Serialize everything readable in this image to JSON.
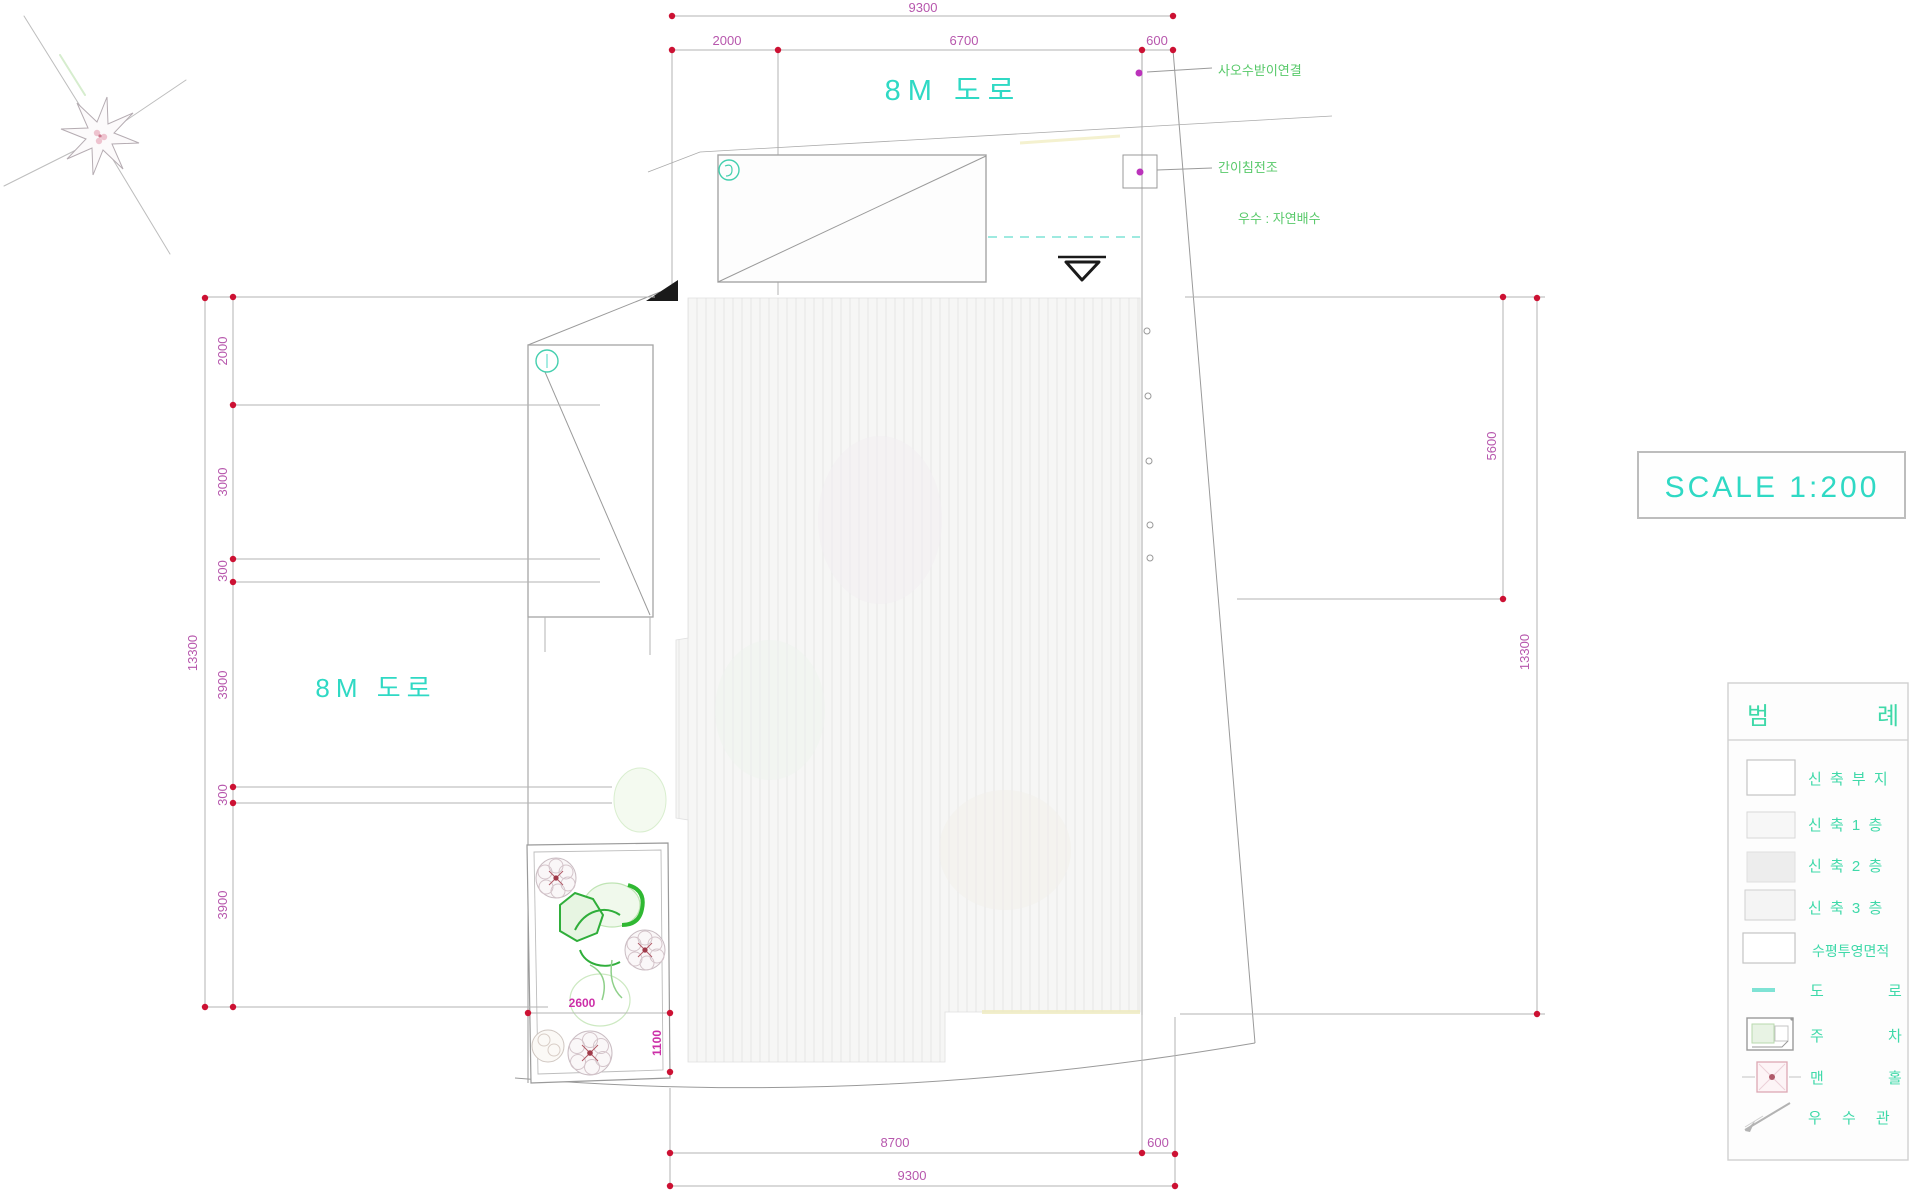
{
  "drawing": {
    "scale_label": "SCALE 1:200",
    "road_top": "8M 도로",
    "road_left": "8M 도로",
    "notes": {
      "note1": "사오수받이연결",
      "note2": "간이침전조",
      "note3": "우수 : 자연배수"
    },
    "dims": {
      "top": [
        "9300",
        "2000",
        "6700",
        "600"
      ],
      "left": [
        "13300",
        "2000",
        "3000",
        "300",
        "3900",
        "300",
        "3900"
      ],
      "right": [
        "5600",
        "13300"
      ],
      "bottom": [
        "8700",
        "600",
        "9300"
      ],
      "garden": [
        "2600",
        "1100"
      ]
    },
    "legend": {
      "header": [
        "범",
        "례"
      ],
      "items": [
        {
          "label": "신 축 부 지"
        },
        {
          "label": "신 축 1 층"
        },
        {
          "label": "신 축 2 층"
        },
        {
          "label": "신 축 3 층"
        },
        {
          "label": "수평투영면적"
        },
        {
          "label": "도 로"
        },
        {
          "label": "주 차"
        },
        {
          "label": "맨 홀"
        },
        {
          "label": "우 수 관"
        }
      ]
    },
    "colors": {
      "dim_text": "#b757ad",
      "dim_dot": "#cc1133",
      "cyan": "#2fd9c4",
      "green": "#58c96a",
      "legend_teal": "#3fd9a9"
    }
  }
}
